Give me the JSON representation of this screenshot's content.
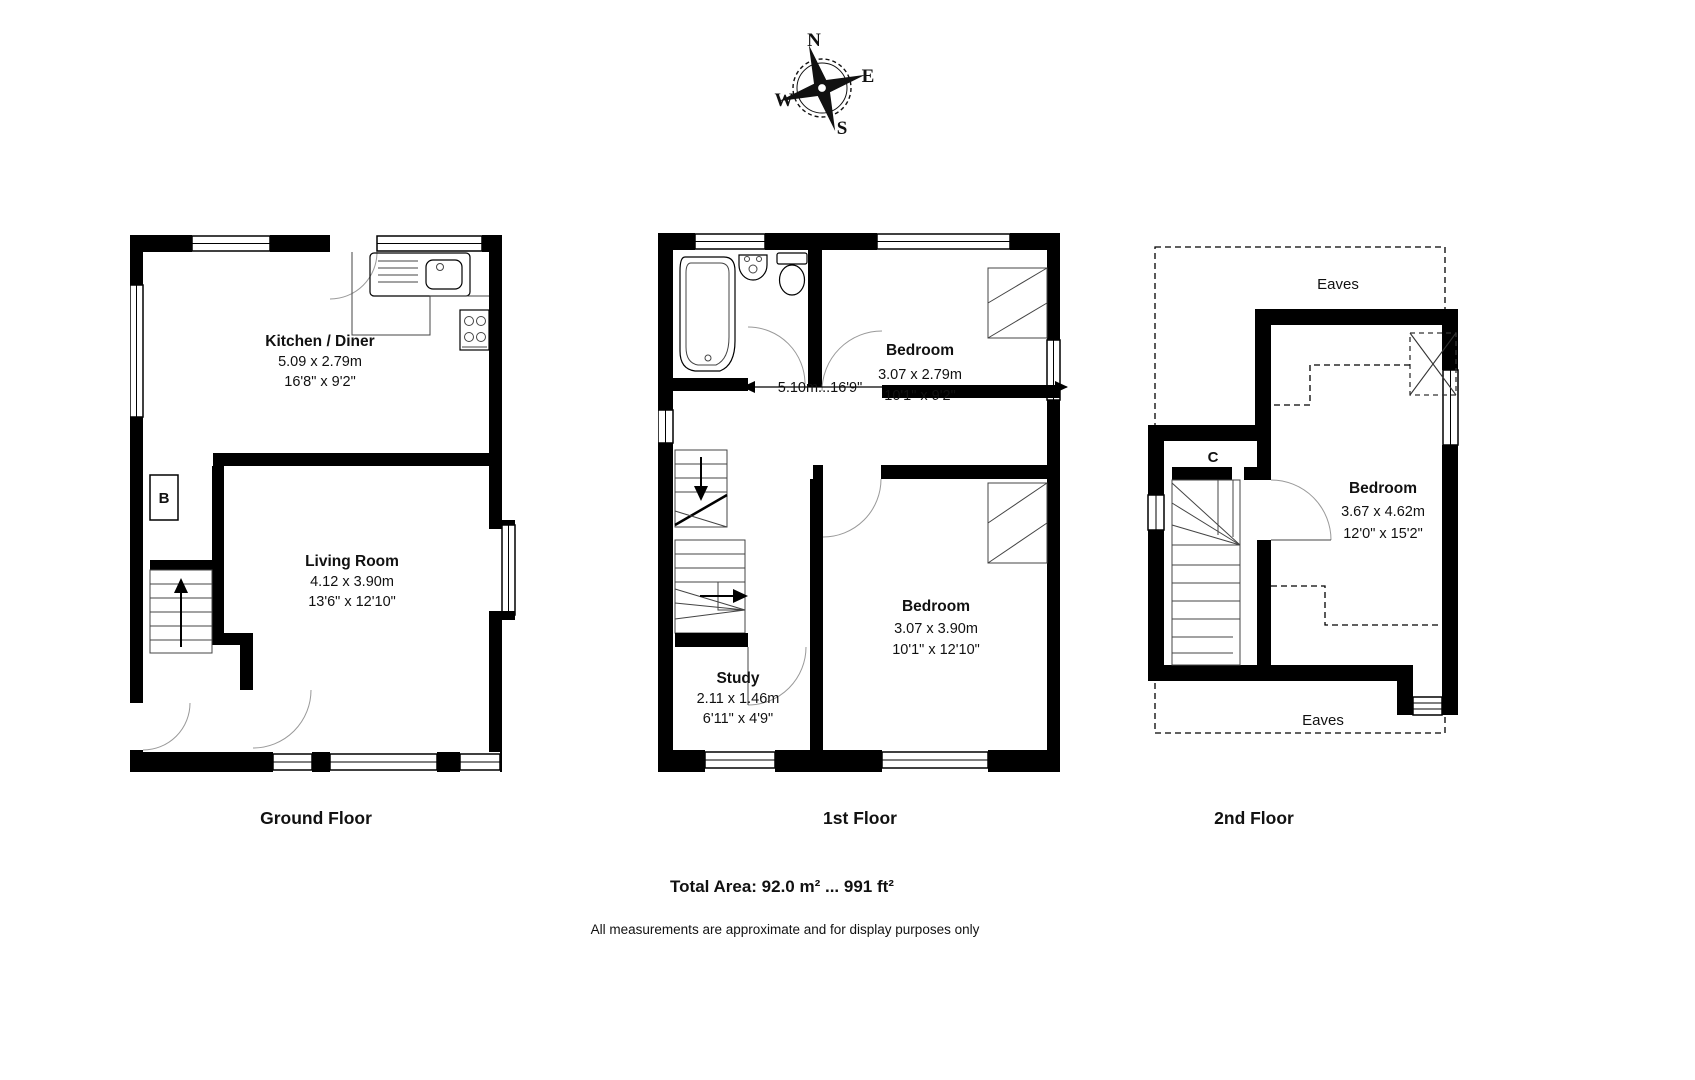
{
  "compass": {
    "n": "N",
    "e": "E",
    "s": "S",
    "w": "W"
  },
  "floors": [
    {
      "title": "Ground Floor",
      "rooms": [
        {
          "name": "Kitchen / Diner",
          "metric": "5.09 x 2.79m",
          "imperial": "16'8\" x 9'2\""
        },
        {
          "name": "Living Room",
          "metric": "4.12 x 3.90m",
          "imperial": "13'6\" x 12'10\""
        }
      ],
      "labels": {
        "boiler": "B"
      }
    },
    {
      "title": "1st Floor",
      "rooms": [
        {
          "name": "Bedroom",
          "metric": "3.07 x 2.79m",
          "imperial": "10'1\" x 9'2\""
        },
        {
          "name": "Bedroom",
          "metric": "3.07 x 3.90m",
          "imperial": "10'1\" x 12'10\""
        },
        {
          "name": "Study",
          "metric": "2.11 x 1.46m",
          "imperial": "6'11\" x 4'9\""
        }
      ],
      "dimension_line": "5.10m...16'9\""
    },
    {
      "title": "2nd Floor",
      "rooms": [
        {
          "name": "Bedroom",
          "metric": "3.67 x 4.62m",
          "imperial": "12'0\" x 15'2\""
        }
      ],
      "labels": {
        "cupboard": "C",
        "eaves_top": "Eaves",
        "eaves_bottom": "Eaves"
      }
    }
  ],
  "footer": {
    "total_area": "Total Area: 92.0 m² ... 991 ft²",
    "disclaimer": "All measurements are approximate and for display purposes only"
  }
}
